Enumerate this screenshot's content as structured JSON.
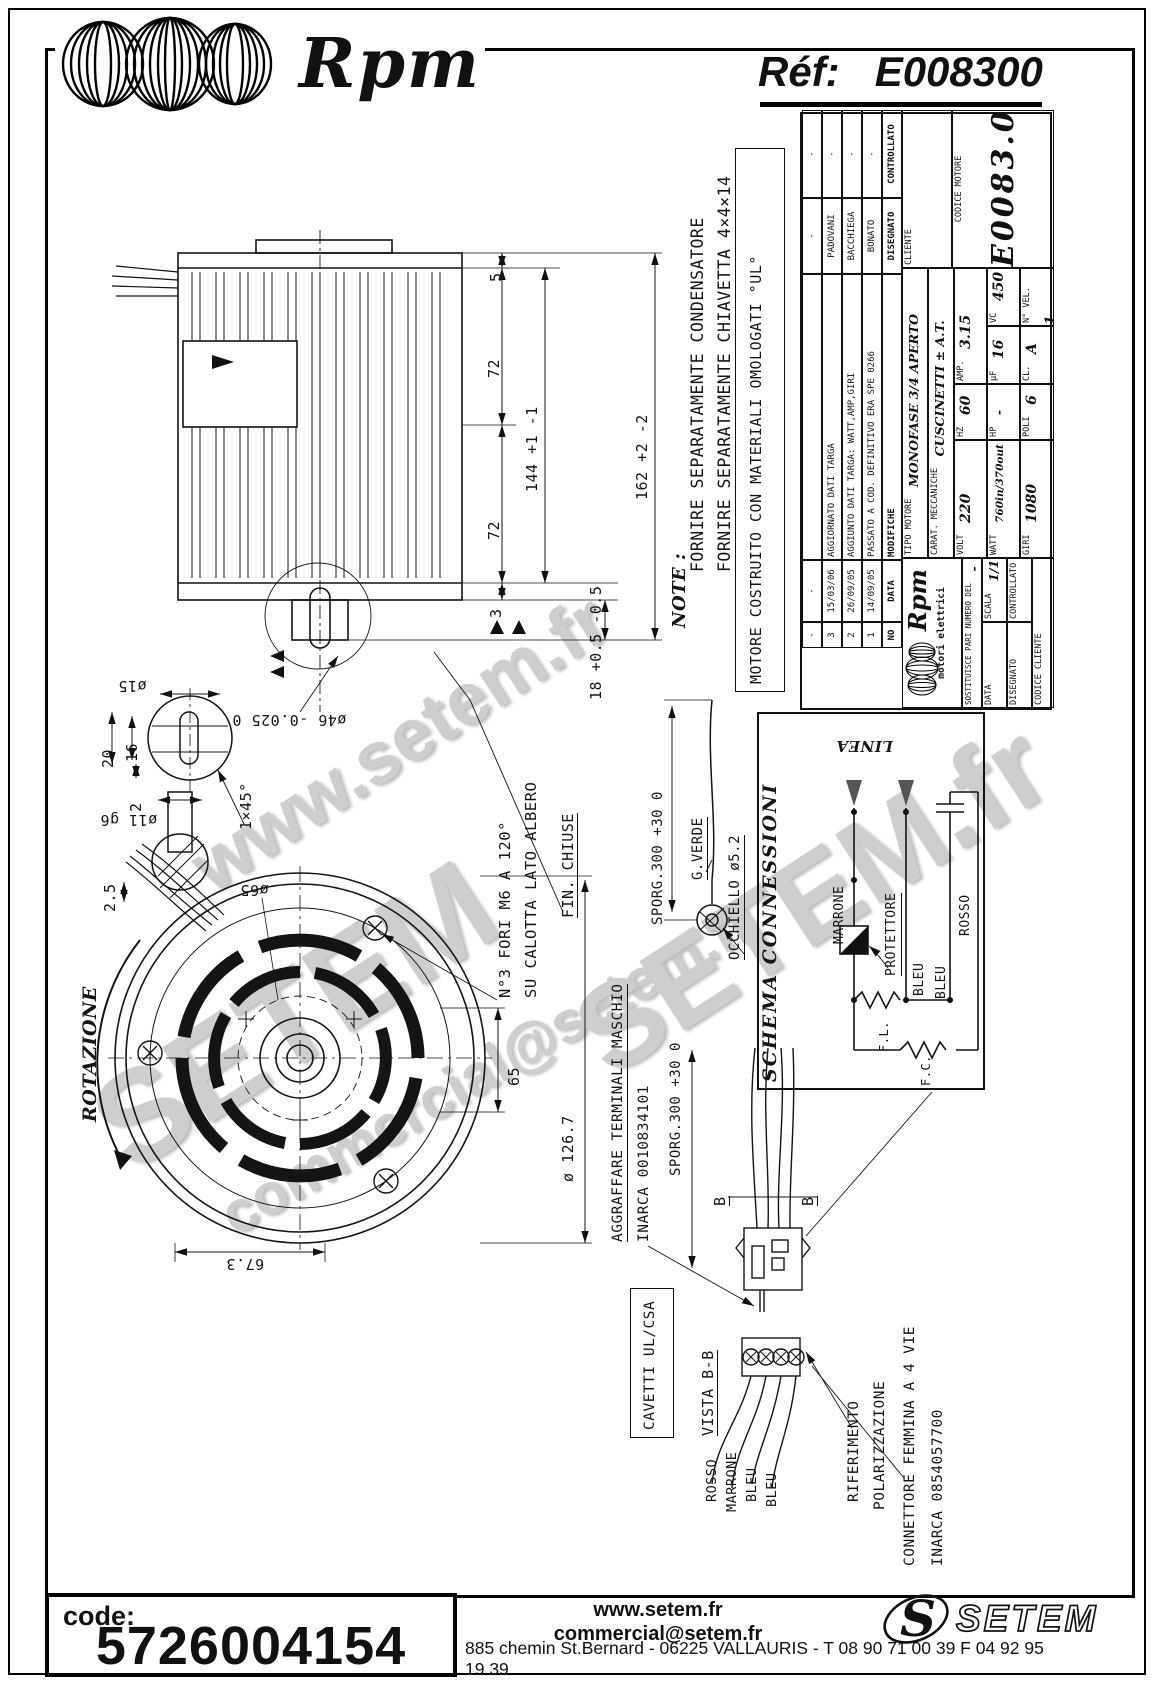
{
  "header": {
    "brand": "Rpm",
    "ref_label": "Réf:",
    "ref_value": "E008300"
  },
  "note": {
    "label": "NOTE :",
    "line1": "FORNIRE SEPARATAMENTE CONDENSATORE",
    "line2": "FORNIRE SEPARATAMENTE CHIAVETTA 4×4×14"
  },
  "ul_box": "MOTORE COSTRUITO CON MATERIALI OMOLOGATI °UL°",
  "dims": {
    "d5": "5",
    "d72a": "72",
    "d72b": "72",
    "d144": "144 +1 -1",
    "d162": "162 +2 -2",
    "d3": "3",
    "d18": "18 +0.5 -0.5",
    "d46": "ø46 -0.025 0",
    "d15": "ø15",
    "d20": "20",
    "d16": "16",
    "d2": "2",
    "chamfer": "1×45°",
    "d11": "ø11 g6",
    "d25": "2.5",
    "d65bc": "ø65",
    "d65": "65",
    "d126": "ø 126.7",
    "d673": "67.3"
  },
  "callouts": {
    "fori1": "N°3 FORI M6 A 120°",
    "fori2": "SU CALOTTA LATO ALBERO",
    "fin": "FIN. CHIUSE",
    "rotazione": "ROTAZIONE",
    "sporg": "SPORG.300 +30 0",
    "gverde": "G.VERDE",
    "occhiello": "OCCHIELLO ø5.2",
    "agg1": "AGGRAFFARE TERMINALI MASCHIO",
    "agg2": "INARCA 0010834101"
  },
  "section": {
    "b": "B",
    "vista": "VISTA B-B",
    "cavetti": "CAVETTI UL/CSA",
    "rosso": "ROSSO",
    "marrone": "MARRONE",
    "bleu1": "BLEU",
    "bleu2": "BLEU",
    "rif1": "RIFERIMENTO",
    "rif2": "POLARIZZAZIONE",
    "conn1": "CONNETTORE FEMMINA A 4 VIE",
    "conn2": "INARCA 0854057700"
  },
  "schema": {
    "title": "SCHEMA CONNESSIONI",
    "linea": "LINEA",
    "marrone": "MARRONE",
    "protettore": "PROTETTORE",
    "bleu1": "BLEU",
    "bleu2": "BLEU",
    "rosso": "ROSSO",
    "fl": "F.L.",
    "fc": "F.C."
  },
  "titleblock": {
    "rev": [
      {
        "no": "-",
        "date": "-",
        "mod": "",
        "des": "-",
        "ctrl": "-"
      },
      {
        "no": "3",
        "date": "15/03/06",
        "mod": "AGGIORNATO DATI TARGA",
        "des": "PADOVANI",
        "ctrl": "-"
      },
      {
        "no": "2",
        "date": "26/09/05",
        "mod": "AGGIUNTO DATI TARGA: WATT,AMP,GIRI",
        "des": "BACCHIEGA",
        "ctrl": "-"
      },
      {
        "no": "1",
        "date": "14/09/05",
        "mod": "PASSATO A COD. DEFINITIVO ERA  SPE 0266",
        "des": "BONATO",
        "ctrl": "-"
      }
    ],
    "hdr": {
      "no": "NO",
      "date": "DATA",
      "mod": "MODIFICHE",
      "des": "DISEGNATO",
      "ctrl": "CONTROLLATO"
    },
    "tipo_l": "TIPO MOTORE",
    "tipo_v": "MONOFASE 3/4 APERTO",
    "carat_l": "CARAT. MECCANICHE",
    "carat_v": "CUSCINETTI ± A.T.",
    "volt_l": "VOLT",
    "volt_v": "220",
    "hz_l": "HZ",
    "hz_v": "60",
    "amp_l": "AMP.",
    "amp_v": "3.15",
    "watt_l": "WATT",
    "watt_v": "760in/370out",
    "hp_l": "HP",
    "hp_v": "-",
    "uf_l": "µF",
    "uf_v": "16",
    "vc_l": "VC",
    "vc_v": "450",
    "giri_l": "GIRI",
    "giri_v": "1080",
    "poli_l": "POLI",
    "poli_v": "6",
    "cl_l": "CL.",
    "cl_v": "A",
    "nvel_l": "N° VEL.",
    "nvel_v": "1",
    "cliente_l": "CLIENTE",
    "codmot_l": "CODICE MOTORE",
    "codmot_v": "E0083.00",
    "codcli_l": "CODICE CLIENTE",
    "brand": "Rpm",
    "brand_sub": "motori elettrici",
    "sost_l": "SOSTITUISCE PARI NUMERO DEL",
    "sost_v": "-",
    "data_l": "DATA",
    "data_v": "14/09/05",
    "scala_l": "SCALA",
    "scala_v": "1/1",
    "dis_l": "DISEGNATO",
    "dis_v": "BONATO",
    "ctrl_l": "CONTROLLATO"
  },
  "watermarks": {
    "w1": "www.setem.fr",
    "w2": "SETEM",
    "w3": "commercial@setem.fr",
    "w4": "SETEM.fr"
  },
  "footer": {
    "code_label": "code:",
    "code_value": "5726004154",
    "site": "www.setem.fr",
    "email": "commercial@setem.fr",
    "logo_s": "S",
    "brand": "SETEM",
    "address": "885 chemin St.Bernard  -  06225 VALLAURIS  -  T 08 90 71 00 39   F 04 92 95 19 39"
  }
}
